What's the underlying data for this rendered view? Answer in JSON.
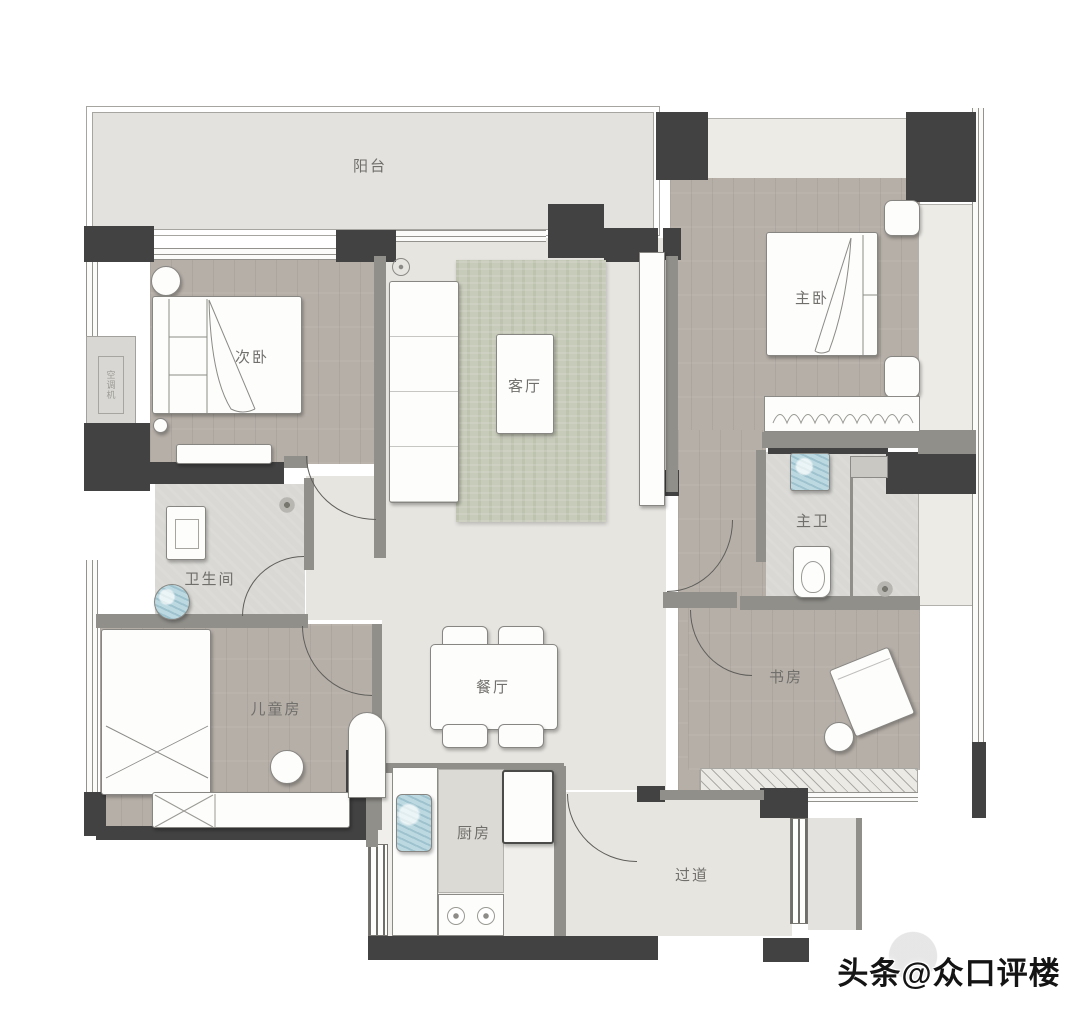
{
  "image_type": "apartment-floor-plan",
  "rooms": {
    "balcony": "阳台",
    "secondary_bedroom": "次卧",
    "living_room": "客厅",
    "master_bedroom": "主卧",
    "bathroom": "卫生间",
    "master_bathroom": "主卫",
    "children_room": "儿童房",
    "dining_room": "餐厅",
    "study": "书房",
    "kitchen": "厨房",
    "hallway": "过道",
    "ac_platform": "空调机"
  },
  "watermark": {
    "text": "头条@众口评楼"
  },
  "colors": {
    "wall": "#424242",
    "partition": "#908f8a",
    "wood_floor": "#b6afa8",
    "cream_floor": "#e7e5e0",
    "tile_floor": "#d9d8d4",
    "balcony_floor": "#e3e2de",
    "kitchen_floor": "#f0efeb",
    "rug": "#c7cbb9",
    "fixture_blue": "#bcd9e1",
    "label_text": "#716f6b"
  }
}
